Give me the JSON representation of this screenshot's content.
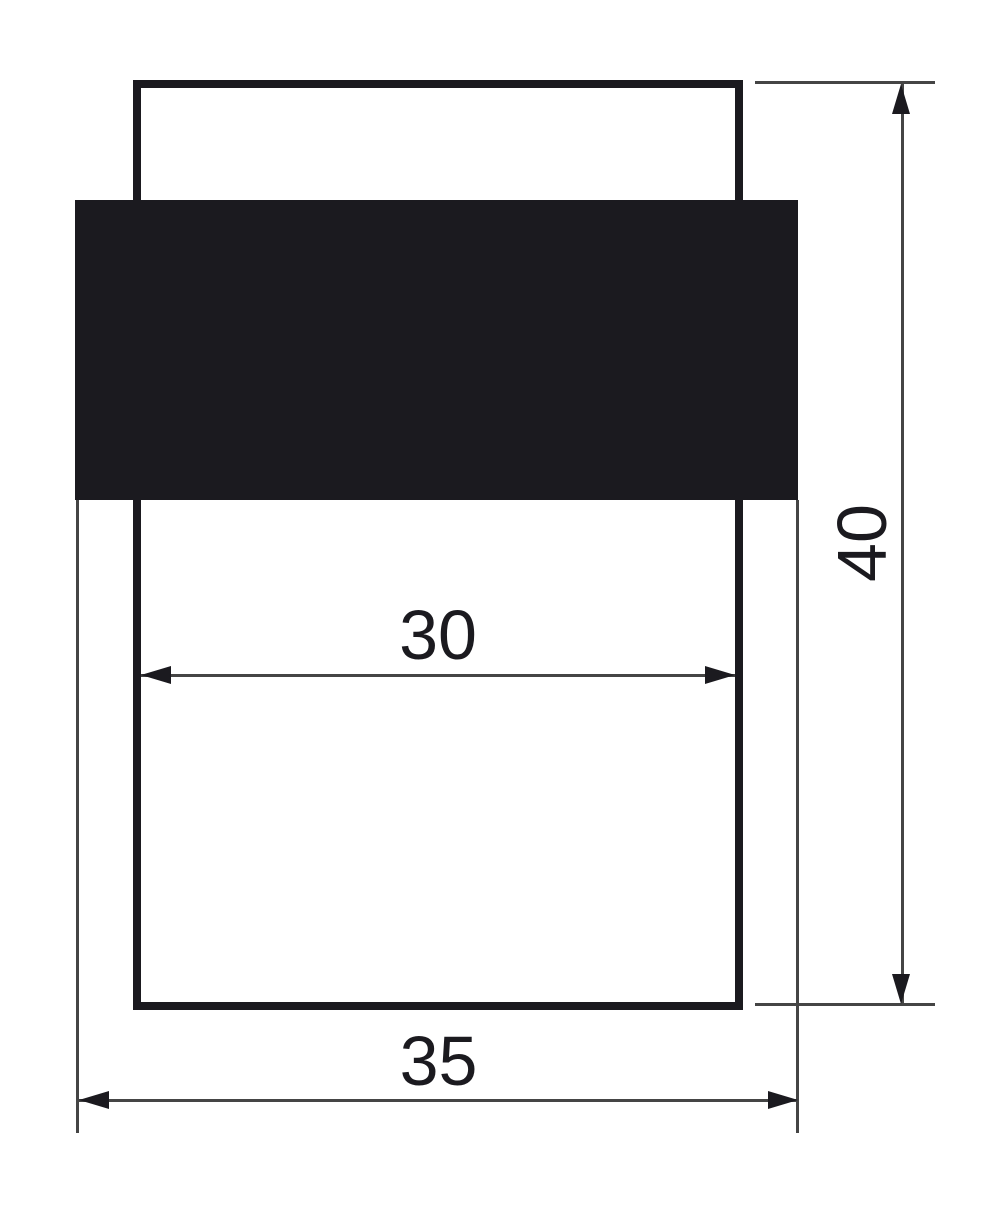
{
  "drawing": {
    "dimensions": {
      "inner_width": {
        "value": "30"
      },
      "outer_width": {
        "value": "35"
      },
      "height": {
        "value": "40"
      }
    },
    "colors": {
      "ink": "#1b1a1f",
      "thin_line": "#454545",
      "background": "#ffffff"
    }
  }
}
